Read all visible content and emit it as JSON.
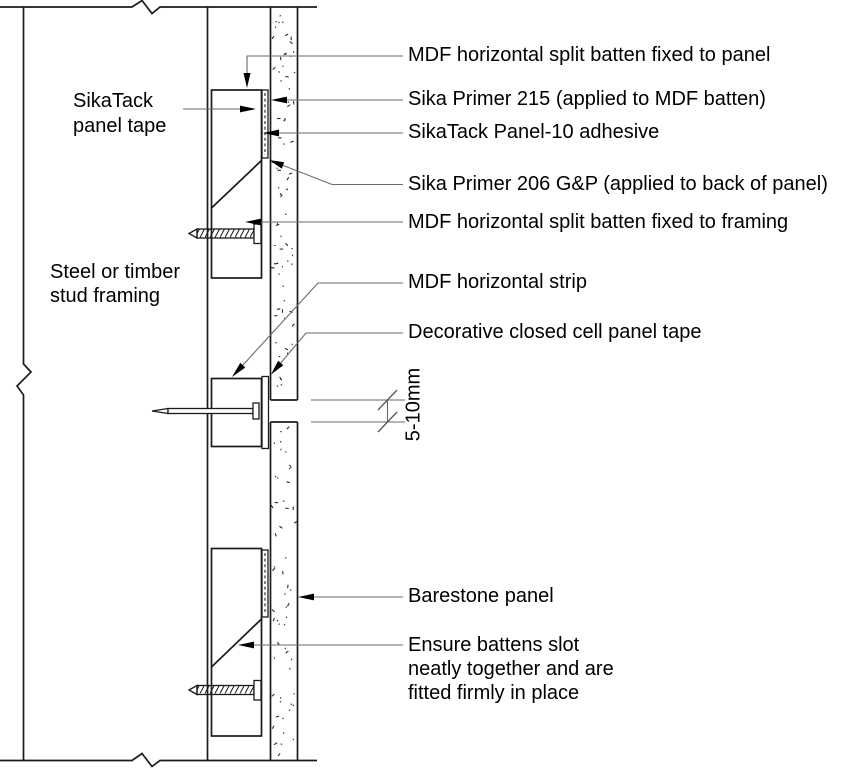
{
  "colors": {
    "background": "#ffffff",
    "drawing_line": "#1b1b1b",
    "leader_line": "#6a6a6a",
    "text": "#000000"
  },
  "labels": {
    "sikatack_panel_tape": "SikaTack\npanel tape",
    "stud_framing": "Steel or timber\nstud framing",
    "mdf_batten_panel": "MDF horizontal split batten fixed to panel",
    "sika_primer_215": "Sika Primer 215 (applied to MDF batten)",
    "sikatack_panel10_adhesive": "SikaTack Panel-10 adhesive",
    "sika_primer_206": "Sika Primer 206 G&P (applied to back of panel)",
    "mdf_batten_framing": "MDF horizontal split batten fixed to framing",
    "mdf_horizontal_strip": "MDF horizontal strip",
    "decorative_tape": "Decorative closed cell panel tape",
    "barestone_panel": "Barestone panel",
    "battens_note": "Ensure battens slot\nneatly together and are\nfitted firmly in place",
    "joint_dimension": "5-10mm"
  }
}
